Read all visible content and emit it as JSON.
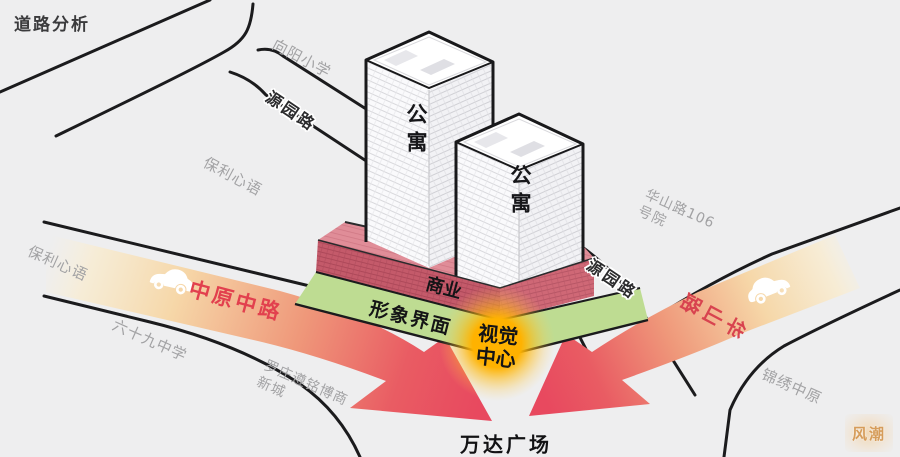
{
  "title": "道路分析",
  "roads": {
    "yuanyuan_top": "源园路",
    "yuanyuan_right": "源园路",
    "zhongyuan_zhonglu": "中原中路",
    "huashan_lu": "华山路"
  },
  "places": {
    "xiangyang_primary": "向阳小学",
    "baoli_xinyu_upper": "保利心语",
    "baoli_xinyu_left": "保利心语",
    "school_69": "六十九中学",
    "luozhuang_line1": "罗庄遵铭博商",
    "luozhuang_line2": "新城",
    "huashan106_line1": "华山路106",
    "huashan106_line2": "号院",
    "jinxiu_zhongyuan": "锦绣中原",
    "wanda_plaza": "万达广场"
  },
  "site": {
    "tower_left": "公寓",
    "tower_right": "公寓",
    "podium": "商业",
    "frontage": "形象界面",
    "visual_center_line1": "视觉",
    "visual_center_line2": "中心"
  },
  "watermark": "风潮",
  "colors": {
    "background": "#eeeeef",
    "road_line": "#1b1b1d",
    "arrow_red": "#e8495f",
    "green_frontage": "#bedc92",
    "podium_pink": "#c45a6a",
    "glow_yellow": "#ffb200",
    "muted_label": "#a2a2a4",
    "avenue_text": "#e2404e"
  }
}
